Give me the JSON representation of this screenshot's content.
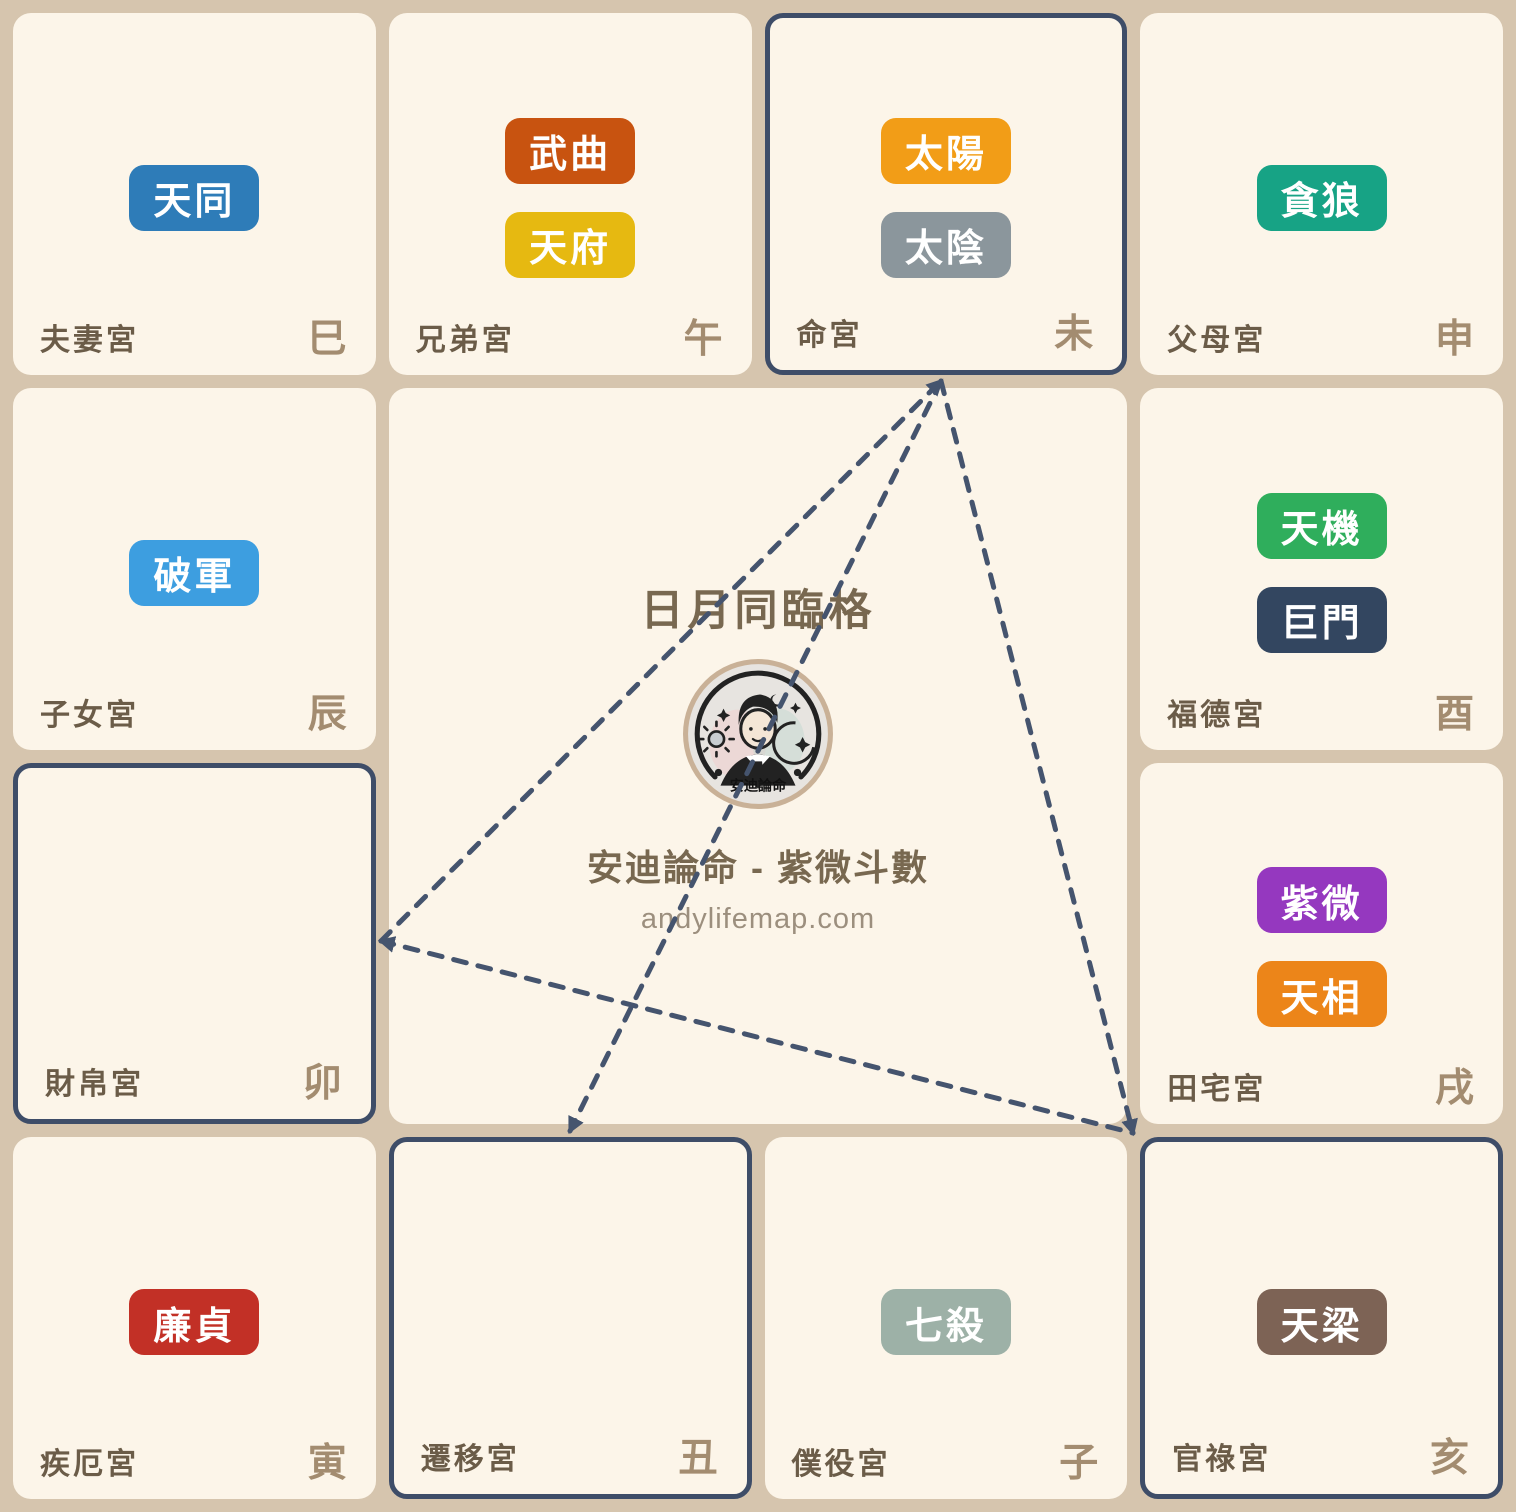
{
  "center": {
    "title": "日月同臨格",
    "brand": "安迪論命 - 紫微斗數",
    "url": "andylifemap.com",
    "logo_text": "安迪論命"
  },
  "theme": {
    "page_background": "#D6C5AE",
    "cell_background": "#FCF5E9",
    "highlight_border": "#3E4D68",
    "dashed_line": "#45546E",
    "palace_label_color": "#6B5C48",
    "branch_label_color": "#A38C70",
    "title_color": "#786850",
    "url_color": "#9C8F7E",
    "logo_ring": "#C9B197",
    "logo_background": "#E7E4E0"
  },
  "palaces": [
    {
      "label": "夫妻宮",
      "branch": "巳",
      "highlighted": false,
      "stars": [
        {
          "name": "天同",
          "color": "#2E7CB8"
        }
      ]
    },
    {
      "label": "兄弟宮",
      "branch": "午",
      "highlighted": false,
      "stars": [
        {
          "name": "武曲",
          "color": "#C85310"
        },
        {
          "name": "天府",
          "color": "#E6B911"
        }
      ]
    },
    {
      "label": "命宮",
      "branch": "未",
      "highlighted": true,
      "stars": [
        {
          "name": "太陽",
          "color": "#F29D17"
        },
        {
          "name": "太陰",
          "color": "#8B969C"
        }
      ]
    },
    {
      "label": "父母宮",
      "branch": "申",
      "highlighted": false,
      "stars": [
        {
          "name": "貪狼",
          "color": "#17A385"
        }
      ]
    },
    {
      "label": "子女宮",
      "branch": "辰",
      "highlighted": false,
      "stars": [
        {
          "name": "破軍",
          "color": "#3D9EE0"
        }
      ]
    },
    {
      "label": "福德宮",
      "branch": "酉",
      "highlighted": false,
      "stars": [
        {
          "name": "天機",
          "color": "#2FAE5C"
        },
        {
          "name": "巨門",
          "color": "#334660"
        }
      ]
    },
    {
      "label": "財帛宮",
      "branch": "卯",
      "highlighted": true,
      "stars": []
    },
    {
      "label": "田宅宮",
      "branch": "戌",
      "highlighted": false,
      "stars": [
        {
          "name": "紫微",
          "color": "#9538BF"
        },
        {
          "name": "天相",
          "color": "#EC8519"
        }
      ]
    },
    {
      "label": "疾厄宮",
      "branch": "寅",
      "highlighted": false,
      "stars": [
        {
          "name": "廉貞",
          "color": "#C23026"
        }
      ]
    },
    {
      "label": "遷移宮",
      "branch": "丑",
      "highlighted": true,
      "stars": []
    },
    {
      "label": "僕役宮",
      "branch": "子",
      "highlighted": false,
      "stars": [
        {
          "name": "七殺",
          "color": "#9DB1A7"
        }
      ]
    },
    {
      "label": "官祿宮",
      "branch": "亥",
      "highlighted": true,
      "stars": [
        {
          "name": "天梁",
          "color": "#7D6355"
        }
      ]
    }
  ]
}
